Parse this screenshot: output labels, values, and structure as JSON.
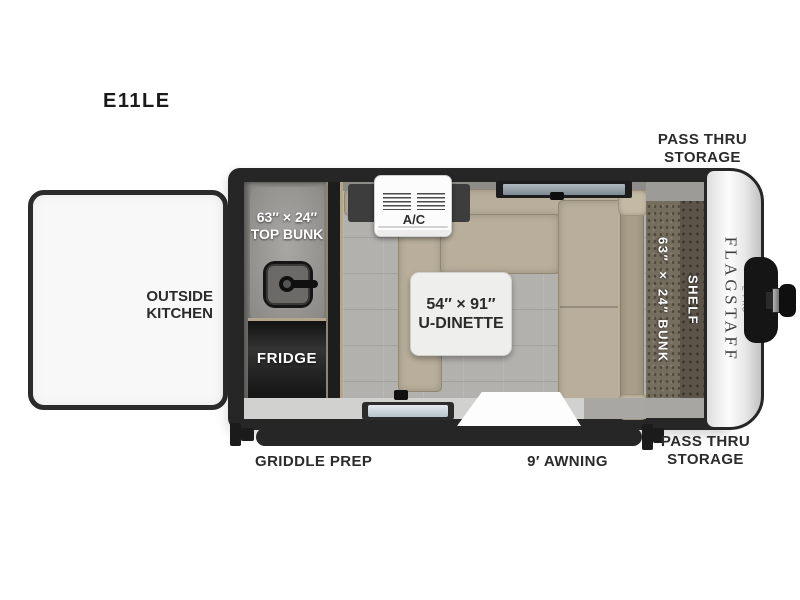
{
  "model": "E11LE",
  "exterior": {
    "pass_thru_top": "PASS THRU\nSTORAGE",
    "pass_thru_bottom": "PASS THRU\nSTORAGE",
    "outside_kitchen": "OUTSIDE\nKITCHEN",
    "griddle_prep": "GRIDDLE PREP",
    "awning": "9′ AWNING"
  },
  "interior": {
    "top_bunk": "63″ × 24″\nTOP BUNK",
    "fridge": "FRIDGE",
    "ac": "A/C",
    "dinette": "54″ × 91″\nU-DINETTE",
    "side_bunk": "63″ × 24″ BUNK",
    "shelf": "SHELF"
  },
  "branding": {
    "name": "FLAGSTAFF",
    "series": "— E-PRO —"
  },
  "icons": {
    "window_hatch": "window-hatch-icon",
    "roof_window": "roof-window-icon",
    "ac_vents": "ac-vents-icon",
    "griddle": "griddle-icon",
    "hitch": "hitch-icon",
    "awning_bar": "awning-bar"
  },
  "colors": {
    "wall": "#262626",
    "cushion": "#b8ae9b",
    "floor": "#b3b1ad",
    "bunk_texture": "#756d5e",
    "counter": "#d1d1cf",
    "label_text": "#2b2b2b",
    "front_cap": "#f5f5f5"
  }
}
